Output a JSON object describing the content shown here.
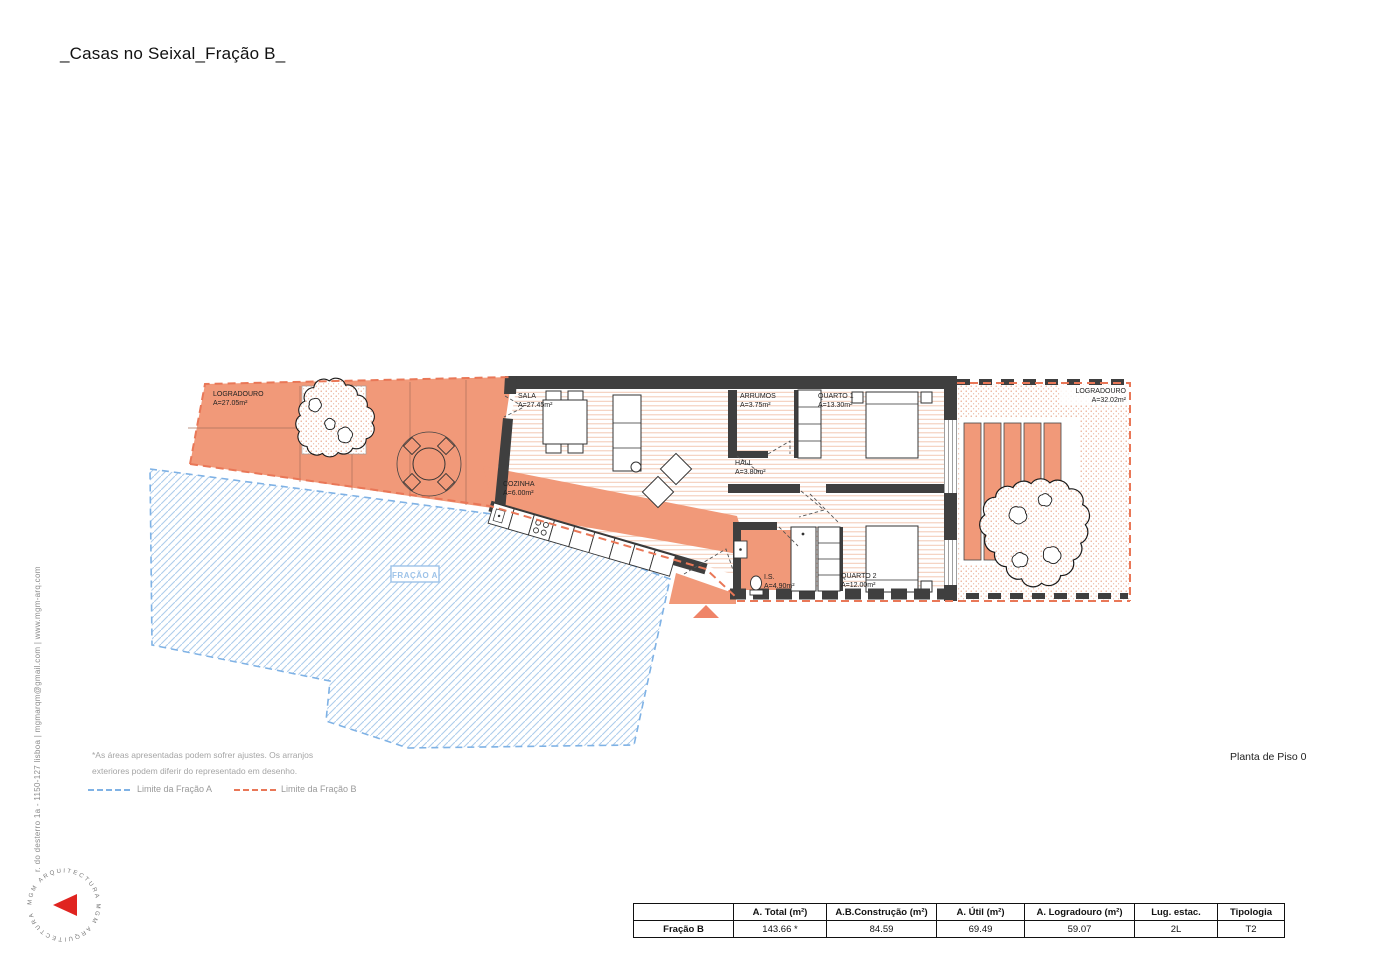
{
  "title": "_Casas no Seixal_Fração B_",
  "drawing_label": "Planta de Piso 0",
  "plan": {
    "rooms": {
      "logradouro_left": {
        "name": "LOGRADOURO",
        "area": "A=27.05m²"
      },
      "sala": {
        "name": "SALA",
        "area": "A=27.45m²"
      },
      "cozinha": {
        "name": "COZINHA",
        "area": "A=6.00m²"
      },
      "hall": {
        "name": "HALL",
        "area": "A=3.80m²"
      },
      "arrumos": {
        "name": "ARRUMOS",
        "area": "A=3.75m²"
      },
      "quarto1": {
        "name": "QUARTO 1",
        "area": "A=13.30m²"
      },
      "is": {
        "name": "I.S.",
        "area": "A=4.90m²"
      },
      "quarto2": {
        "name": "QUARTO 2",
        "area": "A=12.00m²"
      },
      "logradouro_right": {
        "name": "LOGRADOURO",
        "area": "A=32.02m²"
      }
    },
    "fracao_a_label": "FRAÇÃO A"
  },
  "notes": {
    "line1": "*As áreas apresentadas podem sofrer ajustes. Os arranjos",
    "line2": "exteriores podem diferir do representado em desenho."
  },
  "legend": {
    "fracao_a": "Limite da Fração A",
    "fracao_b": "Limite da Fração B"
  },
  "firm": {
    "address": "r. do desterro 1a - 1150-127 lisboa | mgmarqm@gmail.com | www.mgm-arq.com",
    "logo_ring_text": "MGM ARQUITECTURA   MGM ARQUITECTURA"
  },
  "summary_table": {
    "headers": [
      "",
      "A. Total (m²)",
      "A.B.Construção (m²)",
      "A. Útil (m²)",
      "A. Logradouro (m²)",
      "Lug. estac.",
      "Tipologia"
    ],
    "row_label": "Fração B",
    "values": [
      "143.66 *",
      "84.59",
      "69.49",
      "59.07",
      "2L",
      "T2"
    ]
  },
  "colors": {
    "salmon": "#F19979",
    "floor_hatch": "#F3C9B4",
    "wall": "#3F3F3F",
    "limit_b_dash": "#E97757",
    "limit_a_dash": "#7FB2E5",
    "blue_hatch": "#AECDEC",
    "fracao_a_text": "#9CC2E8",
    "logo_red": "#E02420",
    "entrance_marker": "#EF8468"
  }
}
